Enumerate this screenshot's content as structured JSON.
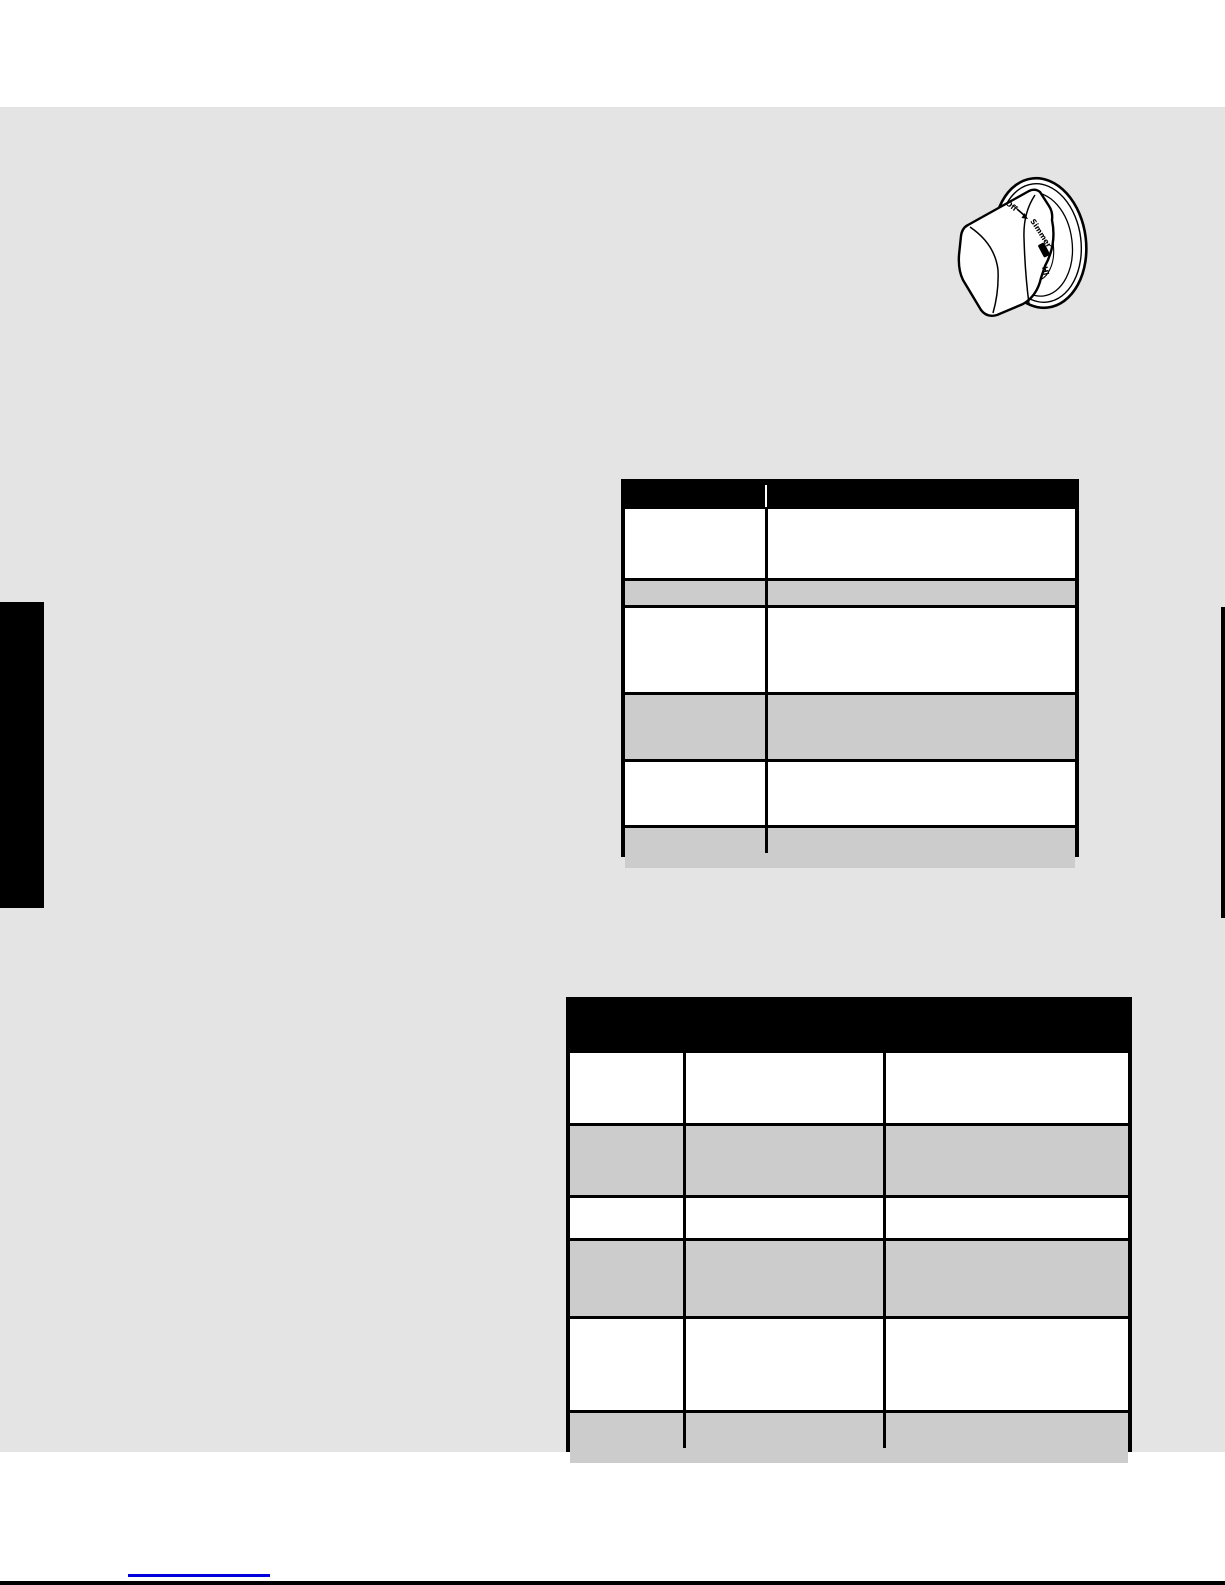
{
  "knob": {
    "labels": {
      "off": "Off",
      "simmer": "Simmer",
      "hi": "Hi"
    },
    "indicator": "hi-range-bar"
  },
  "tables": {
    "upper_table": {
      "header": [
        "",
        ""
      ],
      "rows": [
        [
          "",
          ""
        ],
        [
          "",
          ""
        ],
        [
          "",
          ""
        ],
        [
          "",
          ""
        ],
        [
          "",
          ""
        ],
        [
          "",
          ""
        ]
      ]
    },
    "lower_table": {
      "header": [
        ""
      ],
      "rows": [
        [
          "",
          "",
          ""
        ],
        [
          "",
          "",
          ""
        ],
        [
          "",
          "",
          ""
        ],
        [
          "",
          "",
          ""
        ],
        [
          "",
          "",
          ""
        ],
        [
          "",
          "",
          ""
        ]
      ]
    }
  },
  "footer": {
    "link_text": ""
  },
  "colors": {
    "content_background": "#e4e4e4",
    "row_shade": "#cccccc",
    "table_header": "#000000",
    "link_blue": "#0000dd",
    "ink": "#000000"
  }
}
